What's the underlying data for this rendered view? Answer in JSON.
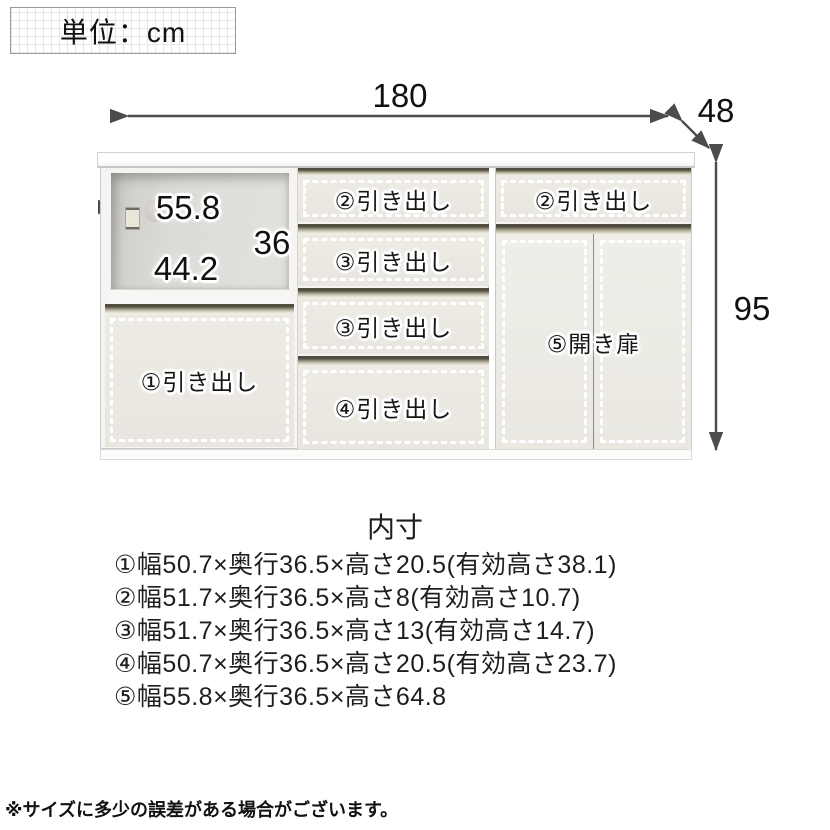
{
  "unit_note": "単位：cm",
  "overall": {
    "width": "180",
    "depth": "48",
    "height": "95"
  },
  "open_shelf": {
    "width": "55.8",
    "height": "36",
    "depth": "44.2"
  },
  "cabinet_labels": {
    "drawer1": "①引き出し",
    "mid_drawer2": "②引き出し",
    "mid_drawer3a": "③引き出し",
    "mid_drawer3b": "③引き出し",
    "mid_drawer4": "④引き出し",
    "right_drawer2": "②引き出し",
    "right_doors": "⑤開き扉"
  },
  "inner_dimensions": {
    "heading": "内寸",
    "items": [
      "①幅50.7×奥行36.5×高さ20.5(有効高さ38.1)",
      "②幅51.7×奥行36.5×高さ8(有効高さ10.7)",
      "③幅51.7×奥行36.5×高さ13(有効高さ14.7)",
      "④幅50.7×奥行36.5×高さ20.5(有効高さ23.7)",
      "⑤幅55.8×奥行36.5×高さ64.8"
    ]
  },
  "footnote": "※サイズに多少の誤差がある場合がございます。",
  "colors": {
    "arrow": "#4c4c4c",
    "drawer_front": "#eae8e1",
    "grip": "#8e8876"
  }
}
